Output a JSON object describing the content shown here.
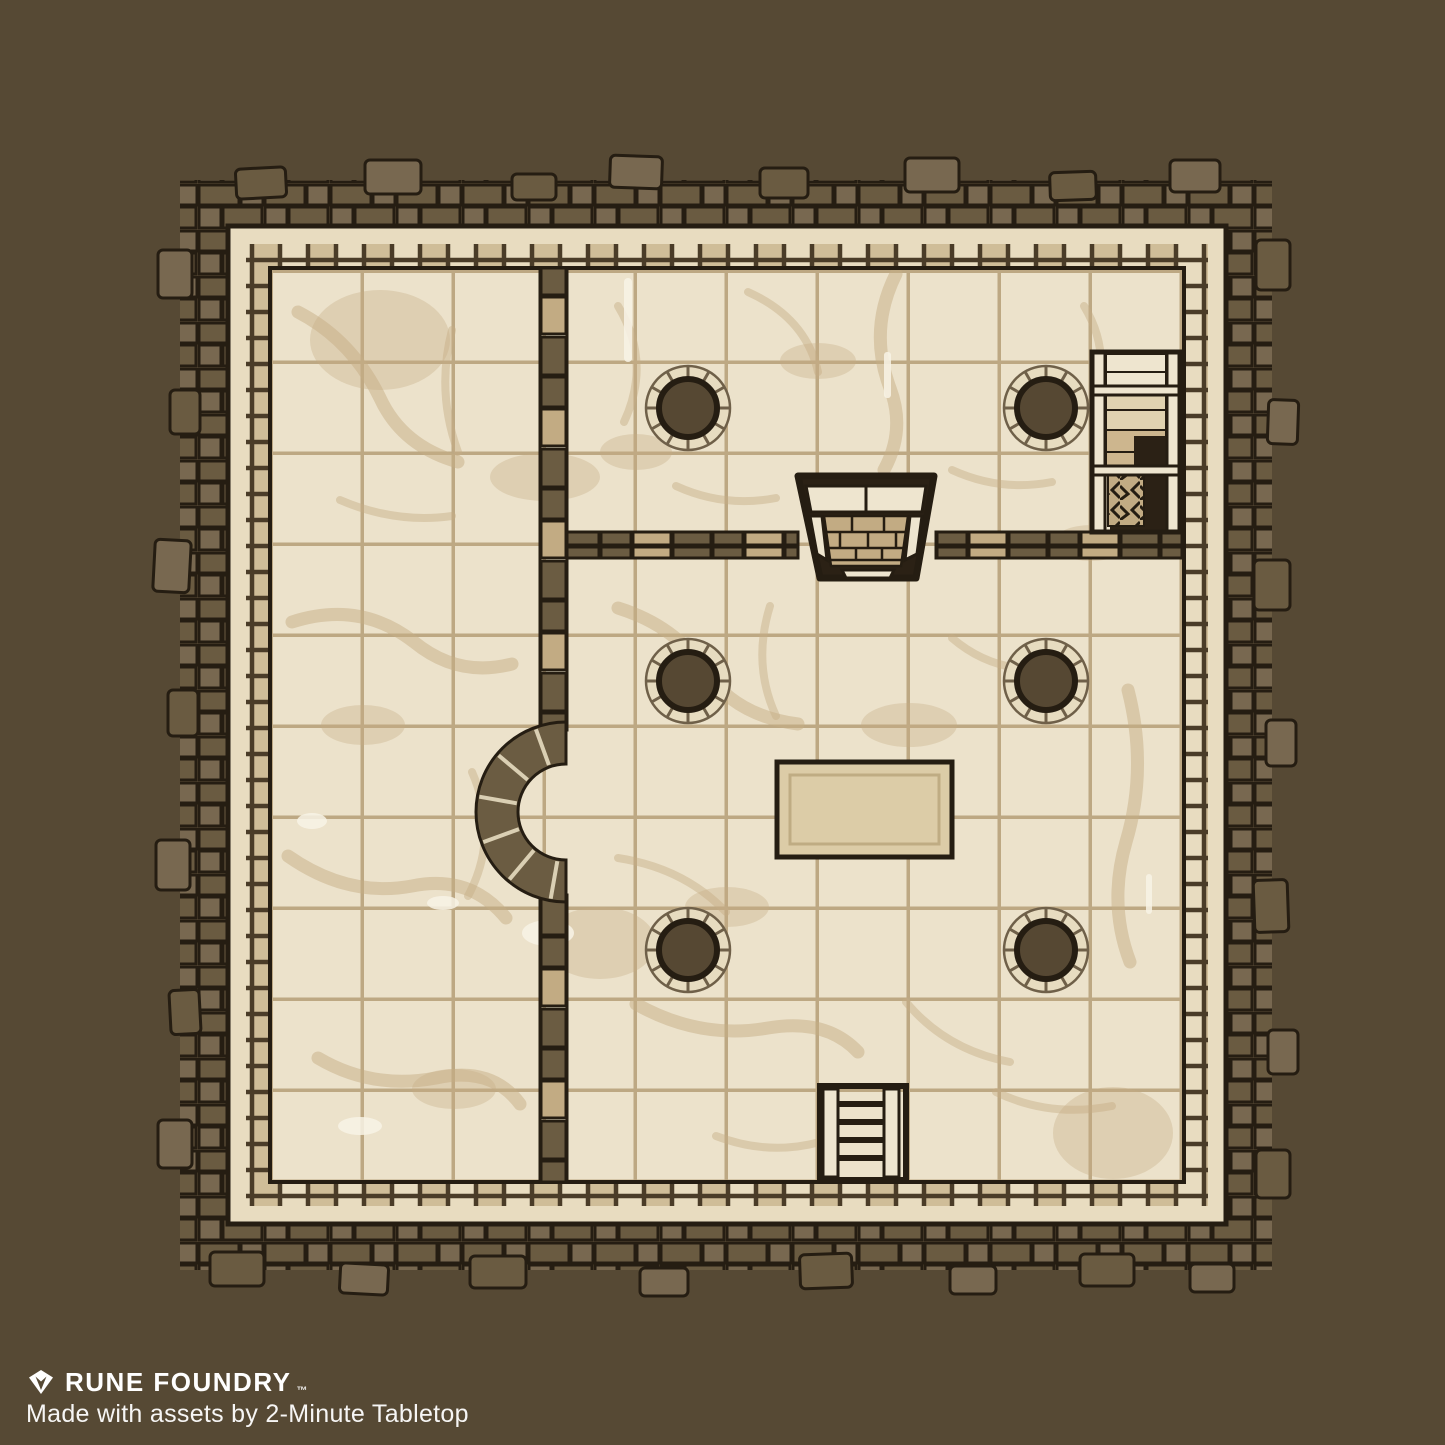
{
  "watermark": {
    "brand": "RUNE FOUNDRY",
    "trademark": "™",
    "credit": "Made with assets by 2-Minute Tabletop"
  },
  "palette": {
    "bg": "#564934",
    "ink": "#251d12",
    "ink-soft": "#4a3c28",
    "stone-a": "#6a5b41",
    "stone-b": "#786850",
    "band": "#e8dcc0",
    "band-block": "#cfbd98",
    "floor": "#ece2cb",
    "grout": "#b59e77",
    "stain": "#c5ad85",
    "iwall": "#6b5c42",
    "iblock": "#c2ab83",
    "ring": "#e7dcc0",
    "ring-line": "#6f6049",
    "core": "#564833",
    "hole": "#2b2115",
    "step-light": "#eee5cf",
    "step-mid": "#e0d2b0",
    "step-tan": "#cdb68e",
    "table": "#dccca7",
    "table-line": "#bfac83",
    "wear": "#f8f3e6",
    "text": "#ffffff"
  },
  "map": {
    "type": "dungeon-battlemap",
    "grid": {
      "columns": 10,
      "rows": 10
    },
    "features": [
      "outer-rubble-wall",
      "perimeter-wall",
      "tiled-stone-floor",
      "interior-wall-vertical",
      "interior-wall-horizontal",
      "arched-alcove",
      "stairwell-hatch",
      "descending-staircase",
      "stone-pillars-x6",
      "stone-table",
      "wooden-ladder"
    ]
  }
}
